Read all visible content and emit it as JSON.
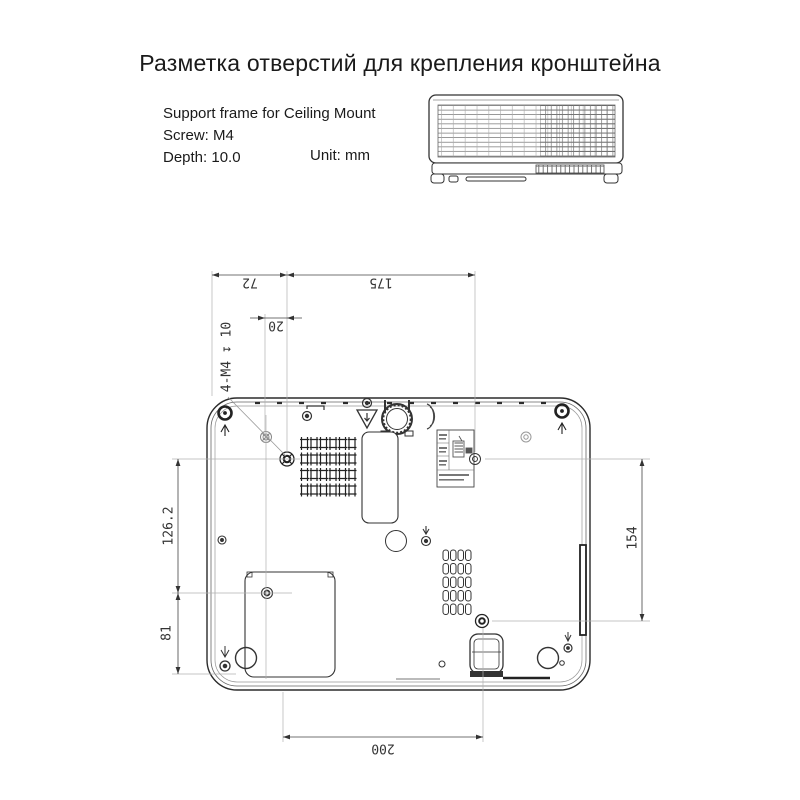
{
  "title": "Разметка отверстий для крепления кронштейна",
  "specs": {
    "support": "Support frame for Ceiling Mount",
    "screw": "Screw: M4",
    "depth": "Depth: 10.0",
    "unit": "Unit: mm"
  },
  "dims": {
    "d72": "72",
    "d175": "175",
    "d20": "20",
    "callout": "4-M4 ↧ 10",
    "d126": "126.2",
    "d81": "81",
    "d154": "154",
    "d200": "200"
  },
  "colors": {
    "ink": "#2b2b2b",
    "dim_line": "#444444",
    "construction": "#b0b0b0"
  }
}
